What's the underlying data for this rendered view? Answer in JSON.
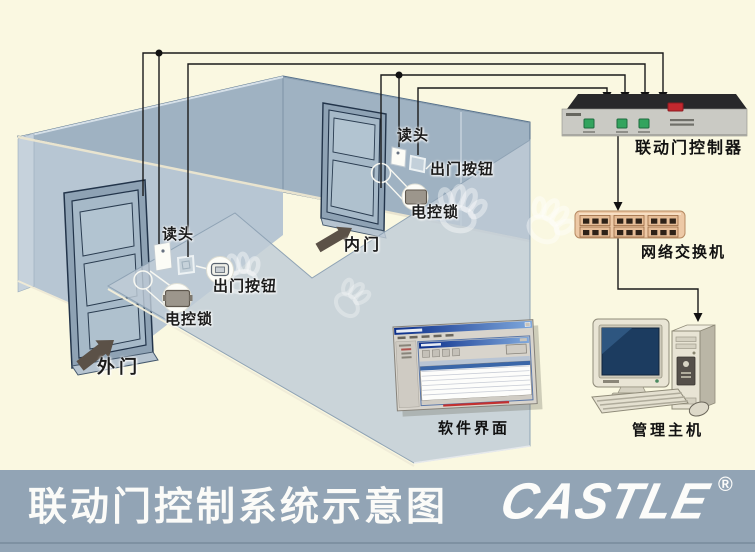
{
  "page": {
    "background_color": "#FAF8E1"
  },
  "labels": {
    "outer_door": "外门",
    "inner_door": "内门",
    "outer_reader": "读头",
    "inner_reader": "读头",
    "outer_exit_button": "出门按钮",
    "inner_exit_button": "出门按钮",
    "outer_lock": "电控锁",
    "inner_lock": "电控锁",
    "controller": "联动门控制器",
    "network_switch": "网络交换机",
    "software": "软件界面",
    "host": "管理主机"
  },
  "banner": {
    "title": "联动门控制系统示意图",
    "logo_text": "CASTLE",
    "registered_mark": "®",
    "background_color": "#92A4B5",
    "text_color": "#FBFBF8"
  },
  "colors": {
    "wall_back": "#9FB2C2",
    "wall_front": "#B7C6D3",
    "pane": "#BFCCD7",
    "wire": "#1A1A1A",
    "controller_body": "#CACAC4",
    "controller_button": "#33A45E",
    "controller_switch": "#C2282E",
    "switch_body": "#EDC9A6",
    "switch_port": "#2E2218",
    "arrow": "#5B5147",
    "monitor_screen": "#1C3C60",
    "case_beige": "#E8E4D4"
  }
}
